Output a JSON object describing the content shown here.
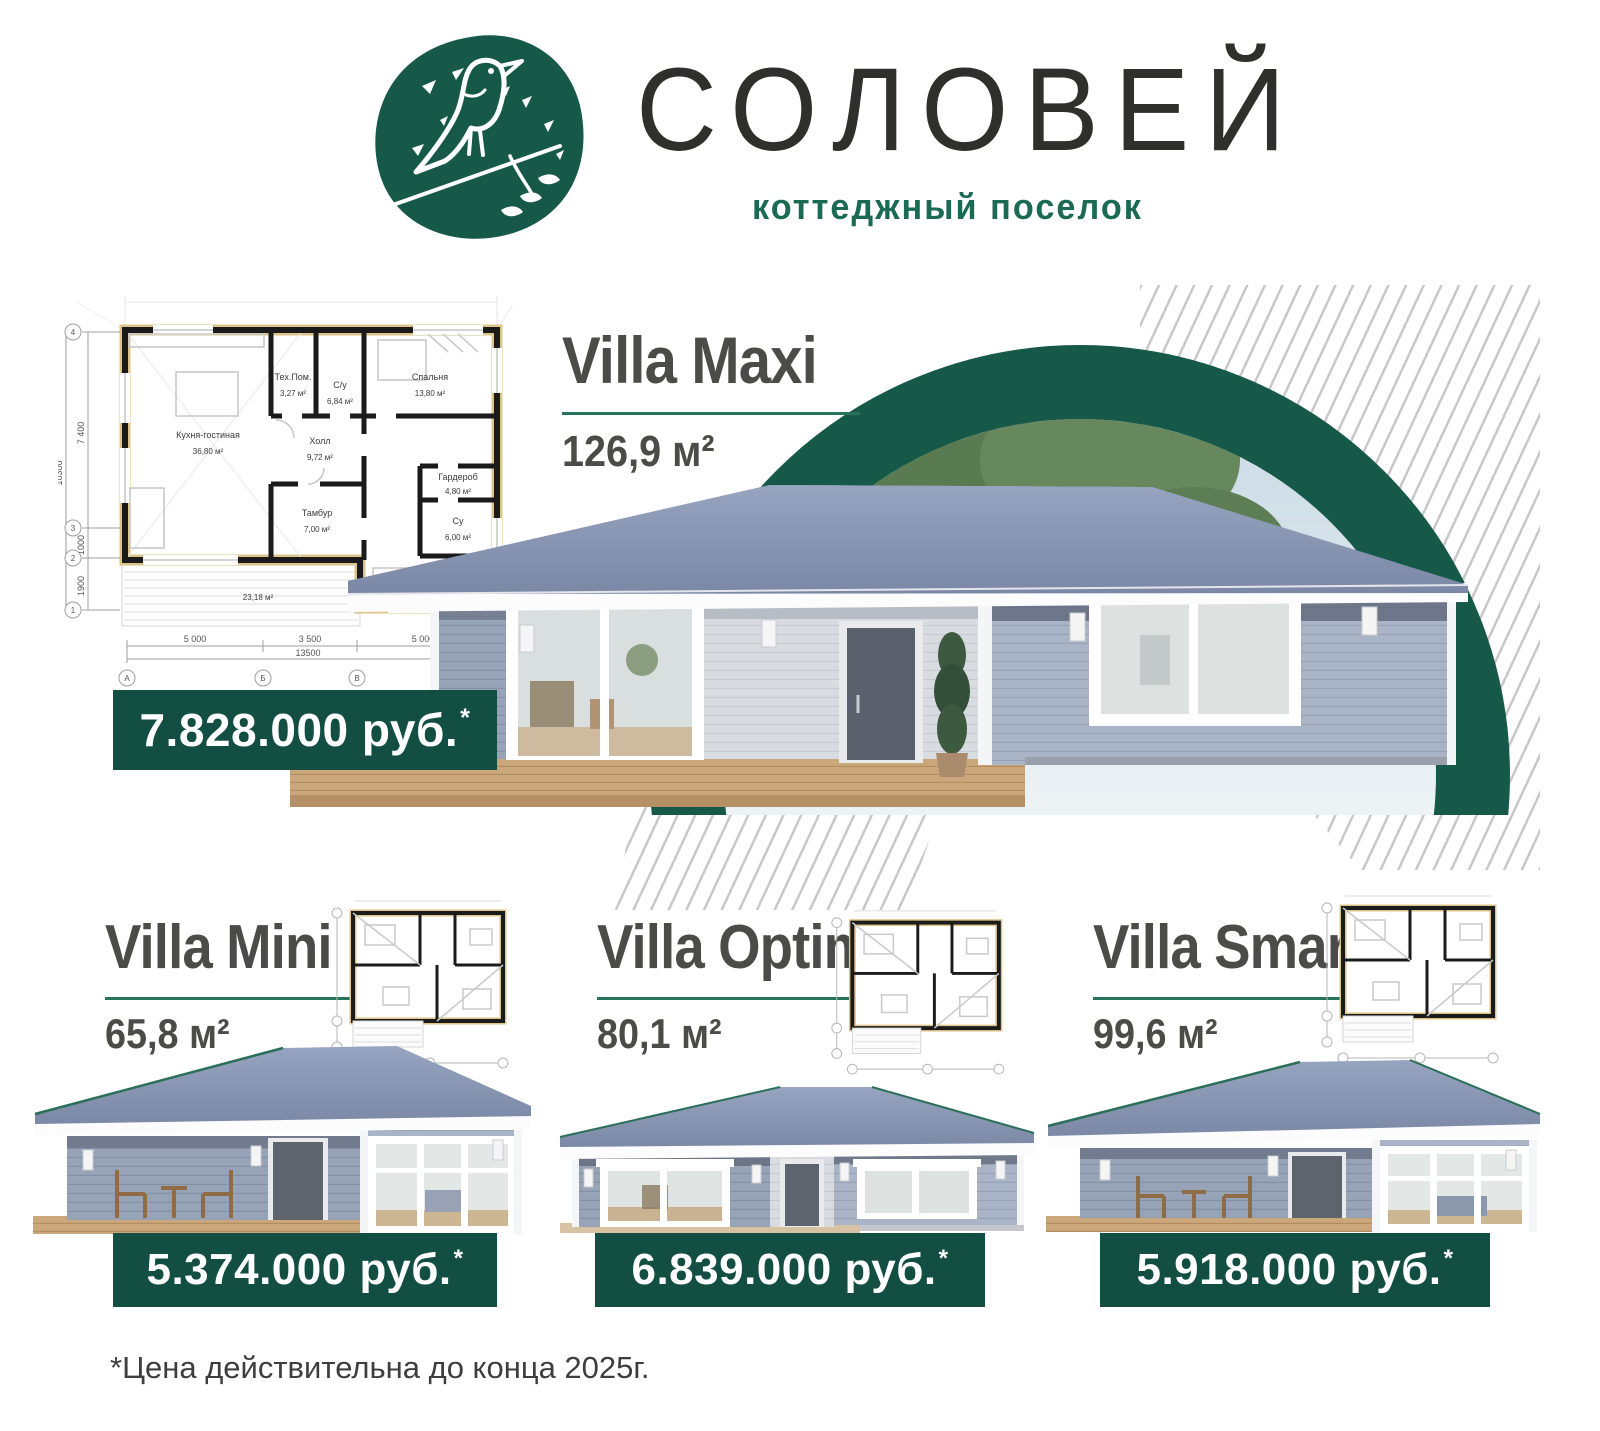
{
  "brand": {
    "title": "СОЛОВЕЙ",
    "subtitle": "коттеджный поселок",
    "logo_icon": "nightingale-bird-icon"
  },
  "colors": {
    "brand_green": "#175949",
    "badge_green": "#124e41",
    "accent_green": "#27735c",
    "title_gray": "#4b4b4a"
  },
  "villa_maxi": {
    "name": "Villa Maxi",
    "area": "126,9 м²",
    "price": "7.828.000 руб.",
    "price_note": "*",
    "plan": {
      "rooms": [
        {
          "name": "Кухня-гостиная",
          "area": "36,80 м²"
        },
        {
          "name": "Тех.Пом.",
          "area": "3,27 м²"
        },
        {
          "name": "С/у",
          "area": "6,84 м²"
        },
        {
          "name": "Спальня",
          "area": "13,80 м²"
        },
        {
          "name": "Холл",
          "area": "9,72 м²"
        },
        {
          "name": "Гардероб",
          "area": "4,80 м²"
        },
        {
          "name": "Тамбур",
          "area": "7,00 м²"
        },
        {
          "name": "Су",
          "area": "6,00 м²"
        },
        {
          "name": "Спальня",
          "area": "16,65 м²"
        }
      ],
      "terrace_area": "23,18 м²",
      "dims_left": [
        "7 400",
        "1000",
        "1900"
      ],
      "dim_left_total": "10300",
      "dims_bottom": [
        "5 000",
        "3 500",
        "5 000"
      ],
      "dim_bottom_total": "13500",
      "grid_rows": [
        "4",
        "3",
        "2",
        "1"
      ],
      "grid_cols": [
        "А",
        "Б",
        "В"
      ]
    }
  },
  "villas": [
    {
      "name": "Villa Mini",
      "area": "65,8 м²",
      "price": "5.374.000 руб.",
      "price_note": "*"
    },
    {
      "name": "Villa Optima",
      "area": "80,1 м²",
      "price": "6.839.000 руб.",
      "price_note": "*"
    },
    {
      "name": "Villa Smart",
      "area": "99,6 м²",
      "price": "5.918.000 руб.",
      "price_note": "*"
    }
  ],
  "footnote": "*Цена действительна до конца 2025г."
}
